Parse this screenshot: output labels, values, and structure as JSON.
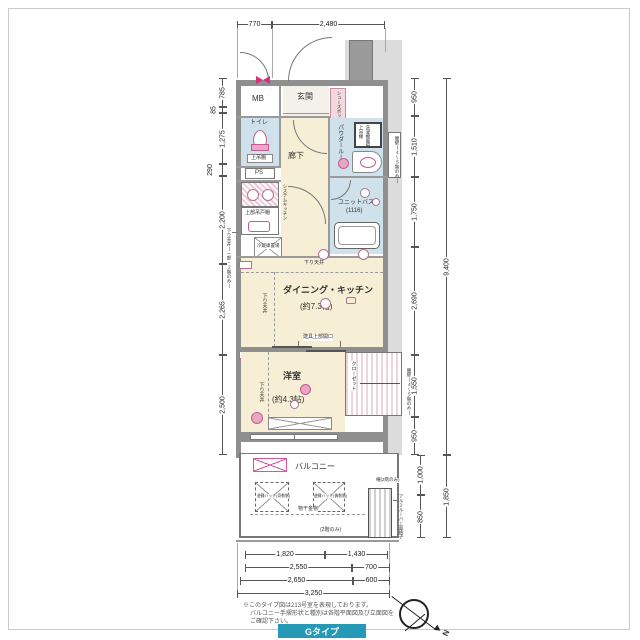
{
  "dims": {
    "top": [
      "770",
      "2,480"
    ],
    "left": [
      "785",
      "85",
      "1,275",
      "290",
      "2,200",
      "2,265",
      "2,500"
    ],
    "right": [
      "950",
      "1,510",
      "1,750",
      "2,690",
      "1,550",
      "950"
    ],
    "right_total": "9,400",
    "lower_right": [
      "1,000",
      "850"
    ],
    "lower_right_total": "1,850",
    "bottom_r1": [
      "1,820",
      "1,430"
    ],
    "bottom_r2": [
      "2,550",
      "700"
    ],
    "bottom_r3": [
      "2,650",
      "600"
    ],
    "bottom_total": "3,250"
  },
  "rooms": {
    "mb": "MB",
    "genkan": "玄関",
    "shoebox": "シューズボックス",
    "toilet": "トイレ",
    "toilet_shelf": "上吊棚",
    "ps": "PS",
    "hall": "廊下",
    "powder": "パウダールーム",
    "washer": "洗濯機置場",
    "washer_shelf": "上吊棚",
    "bath": "ユニットバス",
    "bath_size": "(1116)",
    "kitchen": "システムキッチン",
    "cupboard": "上部吊戸棚",
    "fridge": "冷蔵庫置場",
    "dk": "ダイニング・キッチン",
    "dk_size": "(約7.3帖)",
    "bedroom": "洋室",
    "bedroom_size": "(約4.3帖)",
    "closet": "クローゼット",
    "balcony": "バルコニー"
  },
  "annot": {
    "lowered_ceiling": "下り天井",
    "lowered_ceiling_part": "下り天井(一部・2階のみ)",
    "opening": "建具上部開口",
    "hatch_left": "避難ハッチ(奇数階)",
    "hatch_right": "避難ハッチ(偶数階)",
    "drying": "物干金物",
    "only2f": "(2階のみ)",
    "fence2f": "柵(2階のみ)",
    "louver": "アルミルーバー面格子",
    "waist_wall": "腰壁(4〜5階のみ)"
  },
  "notes": [
    "※このタイプ図は213号室を表現しております。",
    "バルコニー手摺形状と種別は各階平面図及び立面図を",
    "ご確認下さい。"
  ],
  "type_label": "Gタイプ",
  "compass_n": "N"
}
